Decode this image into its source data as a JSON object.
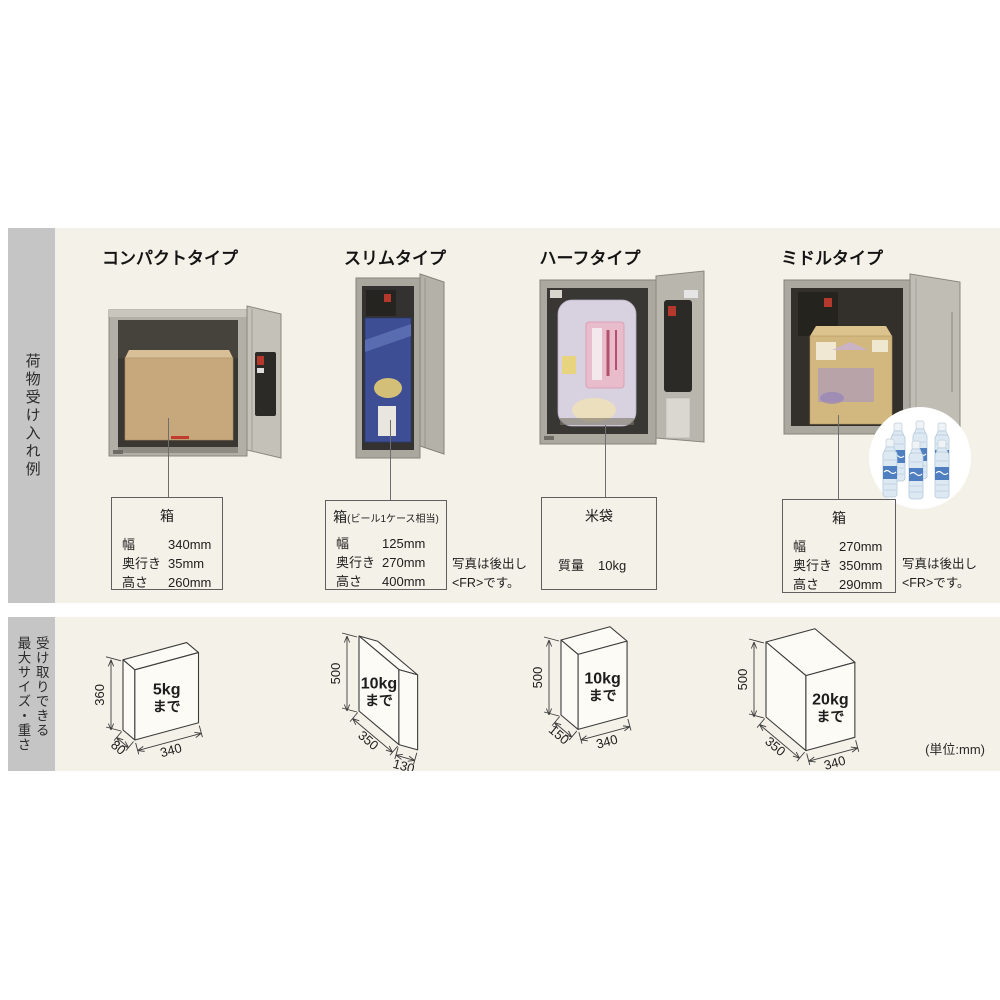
{
  "page": {
    "bg": "#ffffff",
    "content_bg": "#f4f1e8",
    "sidebar_bg": "#c5c5c5",
    "unit_note": "(単位:mm)"
  },
  "sections": {
    "examples": {
      "sidebar_label": "荷物受け入れ例"
    },
    "max_size": {
      "sidebar_label_line1": "受け取りできる",
      "sidebar_label_line2": "最大サイズ・重さ"
    }
  },
  "columns": [
    {
      "title": "コンパクトタイプ",
      "item": {
        "name": "箱",
        "rows": [
          {
            "label": "幅",
            "value": "340mm"
          },
          {
            "label": "奥行き",
            "value": "35mm"
          },
          {
            "label": "高さ",
            "value": "260mm"
          }
        ],
        "note": ""
      }
    },
    {
      "title": "スリムタイプ",
      "item": {
        "name": "箱",
        "name_suffix": "(ビール1ケース相当)",
        "rows": [
          {
            "label": "幅",
            "value": "125mm"
          },
          {
            "label": "奥行き",
            "value": "270mm"
          },
          {
            "label": "高さ",
            "value": "400mm"
          }
        ],
        "note": "写真は後出し\n<FR>です。"
      }
    },
    {
      "title": "ハーフタイプ",
      "item": {
        "name": "米袋",
        "rows": [
          {
            "label": "質量",
            "value": "10kg"
          }
        ],
        "note": ""
      }
    },
    {
      "title": "ミドルタイプ",
      "item": {
        "name": "箱",
        "rows": [
          {
            "label": "幅",
            "value": "270mm"
          },
          {
            "label": "奥行き",
            "value": "350mm"
          },
          {
            "label": "高さ",
            "value": "290mm"
          }
        ],
        "note": "写真は後出し\n<FR>です。"
      }
    }
  ],
  "max_boxes": [
    {
      "width": "340",
      "depth": "80",
      "height": "360",
      "weight": "5kg",
      "weight_suffix": "まで"
    },
    {
      "width": "130",
      "depth": "350",
      "height": "500",
      "weight": "10kg",
      "weight_suffix": "まで"
    },
    {
      "width": "340",
      "depth": "150",
      "height": "500",
      "weight": "10kg",
      "weight_suffix": "まで"
    },
    {
      "width": "340",
      "depth": "350",
      "height": "500",
      "weight": "20kg",
      "weight_suffix": "まで"
    }
  ]
}
